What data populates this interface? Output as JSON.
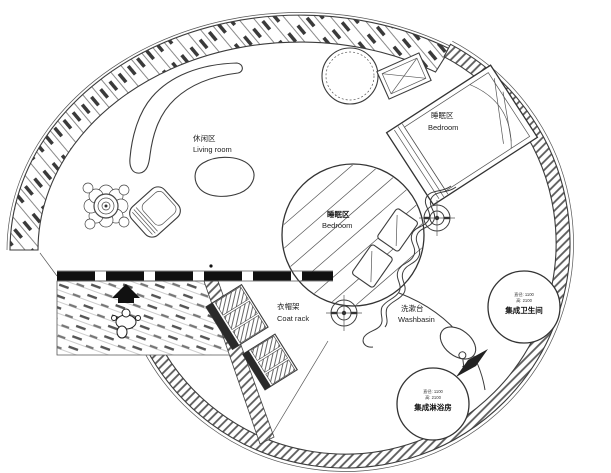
{
  "floor_plan": {
    "labels": {
      "living_room_zh": "休闲区",
      "living_room_en": "Living room",
      "bedroom_upper_zh": "睡眠区",
      "bedroom_upper_en": "Bedroom",
      "bedroom_center_zh": "睡眠区",
      "bedroom_center_en": "Bedroom",
      "coat_rack_zh": "衣帽架",
      "coat_rack_en": "Coat rack",
      "washbasin_zh": "洗漱台",
      "washbasin_en": "Washbasin",
      "bathroom_pod_spec1": "直径: 1100",
      "bathroom_pod_spec2": "高: 2100",
      "bathroom_pod_name": "集成卫生间",
      "shower_pod_spec1": "直径: 1100",
      "shower_pod_spec2": "高: 2100",
      "shower_pod_name": "集成淋浴房"
    },
    "colors": {
      "line": "#3c3c3c",
      "wall_dark": "#111111",
      "background": "#ffffff"
    }
  }
}
